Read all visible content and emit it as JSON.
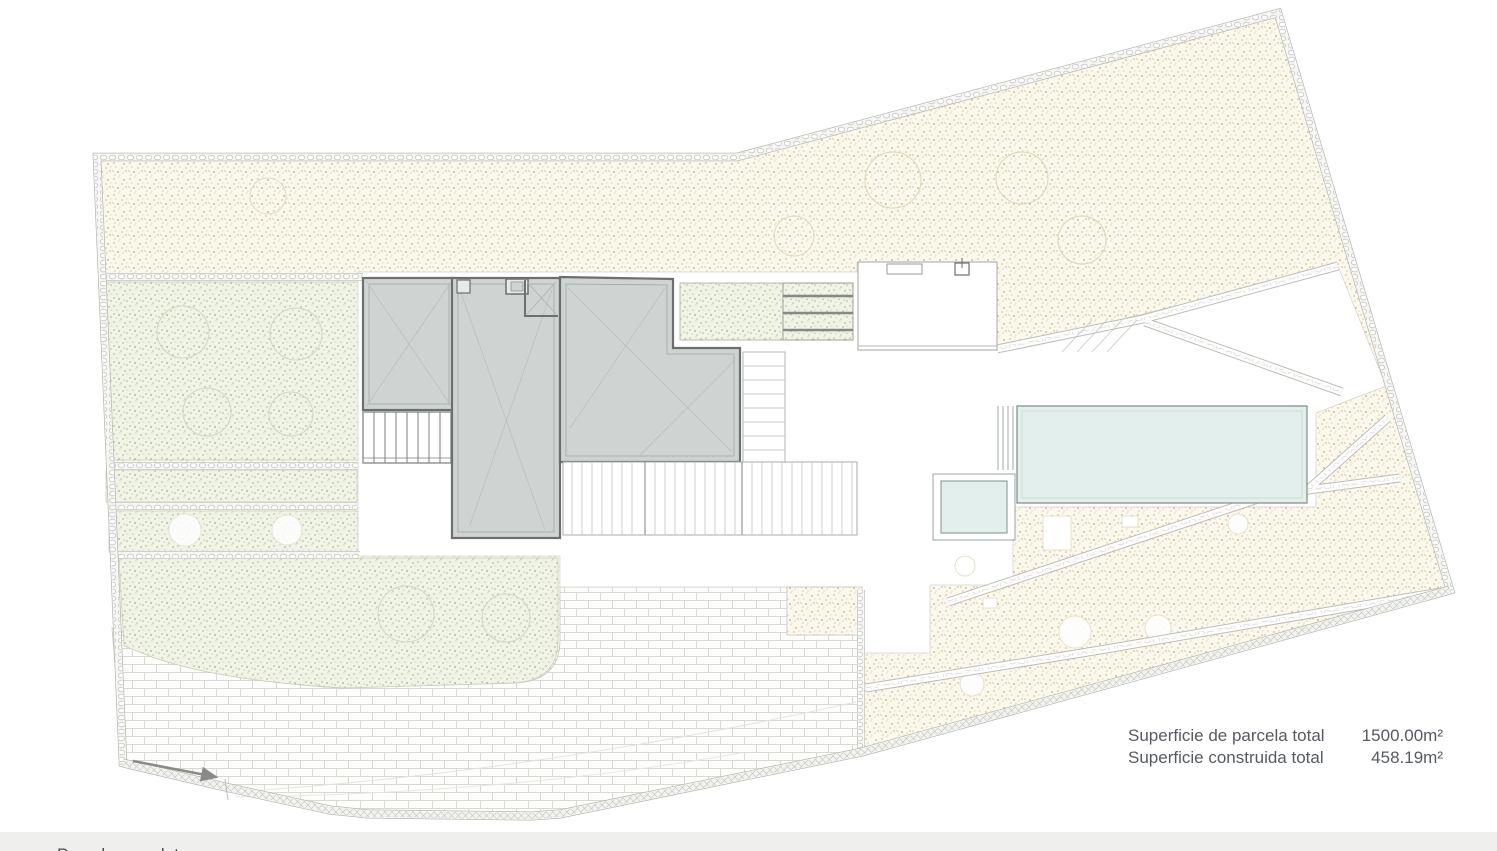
{
  "summary": {
    "rows": [
      {
        "label": "Superficie de parcela total",
        "value": "1500.00m²"
      },
      {
        "label": "Superficie construida total",
        "value": "458.19m²"
      }
    ]
  },
  "footer": {
    "caption": "Parcela completa"
  },
  "colors": {
    "gravel_base": "#fbf8ee",
    "gravel_dot": "#d2c493",
    "lawn_base": "#f0f3e6",
    "lawn_dot": "#b8c9a0",
    "building_fill": "#cfd4d2",
    "building_border": "#6b706e",
    "pool_fill": "#e3efec",
    "pool_border": "#8d9b97",
    "brick_joint": "#d9d9d4",
    "boundary_stone": "#c7c7c2",
    "summary_text": "#565b61",
    "footer_bg": "#efefed"
  }
}
